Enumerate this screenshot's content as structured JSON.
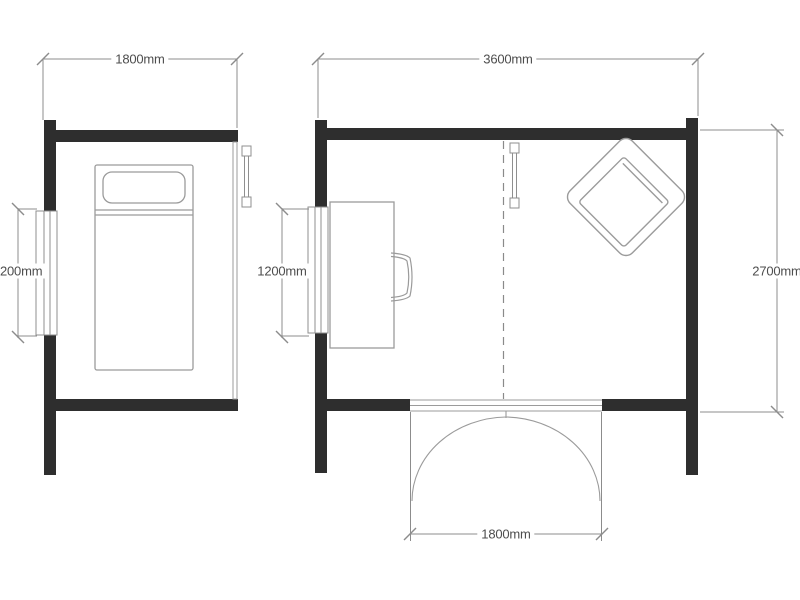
{
  "colors": {
    "wall": "#2e2e2e",
    "furniture_line": "#9b9b9b",
    "dimension_line": "#8c8c8c",
    "text": "#4d4d4d",
    "background": "#ffffff"
  },
  "plans": {
    "small_room": {
      "name": "small garden room floor plan",
      "width_dim": "1800mm",
      "window_dim": "200mm",
      "furniture": [
        "single bed with pillow"
      ],
      "features": [
        "left wall window",
        "thin glazed right wall",
        "wall fixture symbol"
      ]
    },
    "large_room": {
      "name": "large garden room floor plan",
      "width_dim": "3600mm",
      "depth_dim": "2700mm",
      "window_dim": "1200mm",
      "door_dim": "1800mm",
      "furniture": [
        "desk",
        "desk chair",
        "lounge chair rotated 45 degrees"
      ],
      "features": [
        "left wall window",
        "double outward-swing doors",
        "dashed centre line",
        "wall fixture symbol"
      ]
    }
  }
}
